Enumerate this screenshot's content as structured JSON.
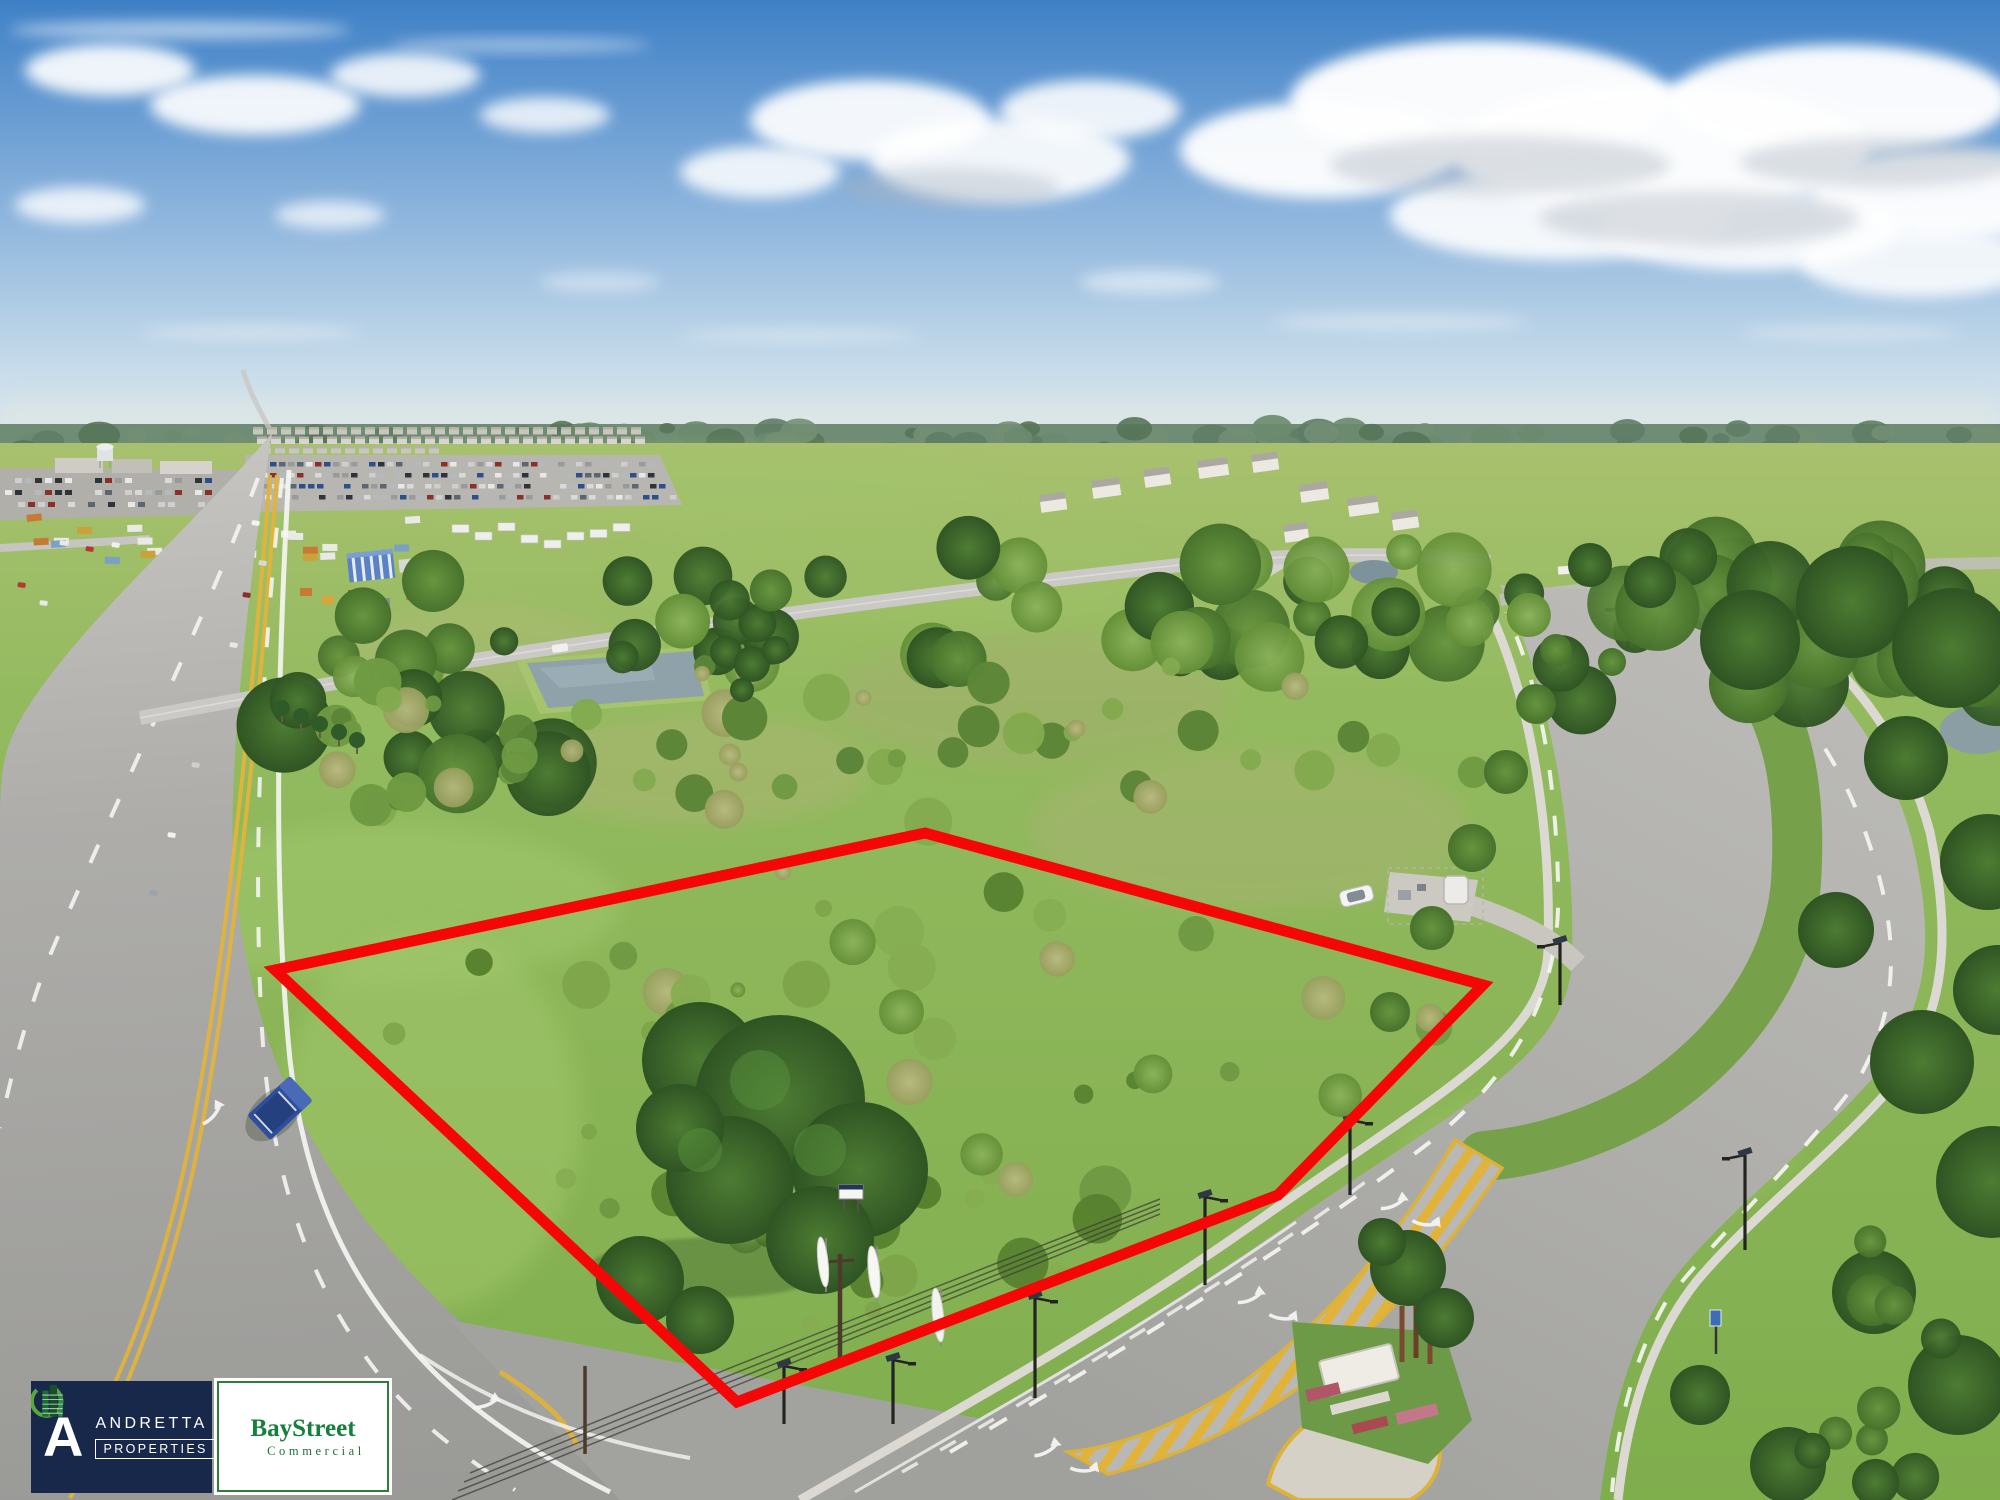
{
  "branding": {
    "andretta": {
      "initial": "A",
      "name": "ANDRETTA",
      "descriptor": "PROPERTIES",
      "background": "#18284a",
      "text_color": "#ffffff"
    },
    "baystreet": {
      "name_part1": "Bay",
      "name_part2": "Street",
      "descriptor": "Commercial",
      "green": "#15803c",
      "border_color": "#2e7d39",
      "background": "#ffffff",
      "icon": "building-swoosh-icon"
    }
  },
  "parcel_overlay": {
    "outline_color": "#f60707",
    "outline_width": 11,
    "points": [
      [
        275,
        970
      ],
      [
        925,
        833
      ],
      [
        1483,
        985
      ],
      [
        1278,
        1195
      ],
      [
        737,
        1402
      ]
    ]
  }
}
